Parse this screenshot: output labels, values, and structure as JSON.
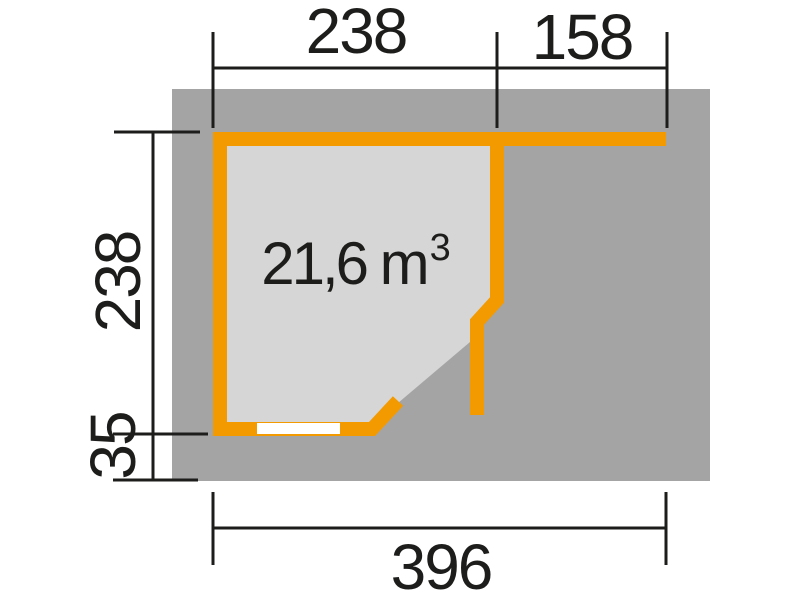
{
  "figure": {
    "type": "floor-plan",
    "room_volume": {
      "text": "21,6 m",
      "exponent": "3"
    },
    "dimensions": {
      "top_width_left": "238",
      "top_width_right": "158",
      "side_height": "238",
      "side_overhang": "35",
      "total_width": "396"
    }
  },
  "colors": {
    "accent_orange": "#f39a00",
    "base_gray": "#a4a4a4",
    "interior_gray": "#d6d6d6",
    "line_black": "#1d1d1b",
    "window_white": "#ffffff",
    "background": "#ffffff"
  }
}
